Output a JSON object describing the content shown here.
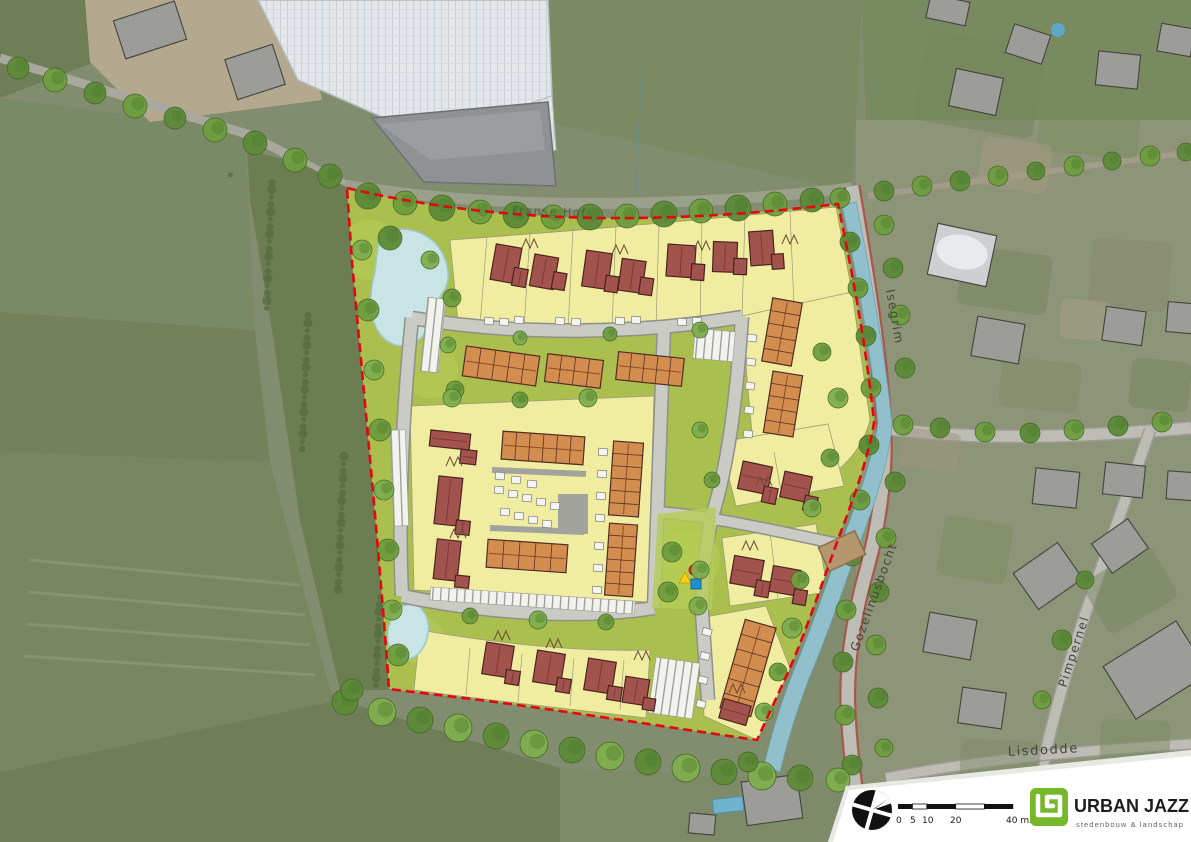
{
  "streets": {
    "franse_hof": "Franse Hof",
    "isegrim": "Isegrim",
    "gozelinusbocht": "Gozelinusbocht",
    "pimpernel": "Pimpernel",
    "lisdodde": "Lisdodde"
  },
  "legend": {
    "scale_ticks": [
      "0",
      "5",
      "10",
      "20"
    ],
    "scale_end": "40 m.",
    "logo_text": "URBAN JAZZ",
    "logo_tagline": "stedenbouw  &  landschap",
    "logo_color": "#76b82a"
  },
  "colors": {
    "boundary": "#e30613",
    "parcel_yellow": "#f1eda0",
    "public_green": "#aabf4e",
    "detached_roof": "#a3534d",
    "terraced_roof": "#d28d4f",
    "road": "#cbcbc5",
    "water": "#8fc0cc",
    "pond": "#c9e4e4",
    "bridge": "#b5976e",
    "playground_triangle": "#f7d117",
    "playground_circle": "#e63027",
    "playground_square": "#1f8fd1"
  },
  "site_plan": {
    "trees": [
      [
        368,
        196,
        13,
        1
      ],
      [
        405,
        203,
        12,
        0
      ],
      [
        442,
        208,
        13,
        1
      ],
      [
        480,
        212,
        12,
        0
      ],
      [
        516,
        215,
        13,
        1
      ],
      [
        553,
        217,
        12,
        0
      ],
      [
        590,
        217,
        13,
        1
      ],
      [
        627,
        216,
        12,
        0
      ],
      [
        664,
        214,
        13,
        1
      ],
      [
        701,
        211,
        12,
        0
      ],
      [
        738,
        208,
        13,
        1
      ],
      [
        775,
        204,
        12,
        0
      ],
      [
        812,
        200,
        12,
        1
      ],
      [
        840,
        198,
        10,
        0
      ],
      [
        18,
        68,
        11,
        1
      ],
      [
        55,
        80,
        12,
        0
      ],
      [
        95,
        93,
        11,
        1
      ],
      [
        135,
        106,
        12,
        0
      ],
      [
        175,
        118,
        11,
        1
      ],
      [
        215,
        130,
        12,
        0
      ],
      [
        255,
        143,
        12,
        1
      ],
      [
        295,
        160,
        12,
        0
      ],
      [
        330,
        176,
        12,
        1
      ],
      [
        362,
        250,
        10,
        2
      ],
      [
        368,
        310,
        11,
        0
      ],
      [
        374,
        370,
        10,
        2
      ],
      [
        380,
        430,
        11,
        0
      ],
      [
        384,
        490,
        10,
        2
      ],
      [
        388,
        550,
        11,
        0
      ],
      [
        392,
        610,
        10,
        2
      ],
      [
        398,
        655,
        11,
        0
      ],
      [
        390,
        238,
        12,
        1
      ],
      [
        430,
        260,
        9,
        2
      ],
      [
        452,
        298,
        9,
        0
      ],
      [
        448,
        345,
        8,
        2
      ],
      [
        455,
        390,
        9,
        0
      ],
      [
        452,
        398,
        9,
        2
      ],
      [
        520,
        400,
        8,
        0
      ],
      [
        588,
        398,
        9,
        2
      ],
      [
        470,
        616,
        8,
        0
      ],
      [
        538,
        620,
        9,
        2
      ],
      [
        606,
        622,
        8,
        0
      ],
      [
        520,
        338,
        7,
        2
      ],
      [
        610,
        334,
        7,
        0
      ],
      [
        700,
        330,
        8,
        2
      ],
      [
        672,
        552,
        10,
        0
      ],
      [
        700,
        570,
        9,
        2
      ],
      [
        668,
        592,
        10,
        0
      ],
      [
        698,
        606,
        9,
        2
      ],
      [
        712,
        480,
        8,
        0
      ],
      [
        700,
        430,
        8,
        2
      ],
      [
        822,
        352,
        9,
        0
      ],
      [
        838,
        398,
        10,
        2
      ],
      [
        830,
        458,
        9,
        0
      ],
      [
        812,
        508,
        9,
        2
      ],
      [
        800,
        580,
        9,
        0
      ],
      [
        792,
        628,
        10,
        2
      ],
      [
        778,
        672,
        9,
        0
      ],
      [
        764,
        712,
        9,
        2
      ],
      [
        850,
        242,
        10,
        1
      ],
      [
        858,
        288,
        10,
        0
      ],
      [
        866,
        336,
        10,
        1
      ],
      [
        871,
        388,
        10,
        0
      ],
      [
        869,
        445,
        10,
        1
      ],
      [
        860,
        500,
        10,
        0
      ],
      [
        852,
        556,
        10,
        1
      ],
      [
        846,
        610,
        10,
        0
      ],
      [
        843,
        662,
        10,
        1
      ],
      [
        845,
        715,
        10,
        0
      ],
      [
        852,
        765,
        10,
        1
      ],
      [
        884,
        225,
        10,
        0
      ],
      [
        893,
        268,
        10,
        1
      ],
      [
        900,
        315,
        10,
        0
      ],
      [
        905,
        368,
        10,
        1
      ],
      [
        903,
        425,
        10,
        0
      ],
      [
        895,
        482,
        10,
        1
      ],
      [
        886,
        538,
        10,
        0
      ],
      [
        879,
        592,
        10,
        1
      ],
      [
        876,
        645,
        10,
        0
      ],
      [
        878,
        698,
        10,
        1
      ],
      [
        884,
        748,
        9,
        0
      ],
      [
        940,
        428,
        10,
        1
      ],
      [
        985,
        432,
        10,
        0
      ],
      [
        1030,
        433,
        10,
        1
      ],
      [
        1074,
        430,
        10,
        0
      ],
      [
        1118,
        426,
        10,
        1
      ],
      [
        1162,
        422,
        10,
        0
      ],
      [
        884,
        191,
        10,
        1
      ],
      [
        922,
        186,
        10,
        0
      ],
      [
        960,
        181,
        10,
        1
      ],
      [
        998,
        176,
        10,
        0
      ],
      [
        1036,
        171,
        9,
        1
      ],
      [
        1074,
        166,
        10,
        0
      ],
      [
        1112,
        161,
        9,
        1
      ],
      [
        1150,
        156,
        10,
        0
      ],
      [
        1186,
        152,
        9,
        1
      ],
      [
        1062,
        640,
        10,
        1
      ],
      [
        1042,
        700,
        9,
        0
      ],
      [
        1085,
        580,
        9,
        1
      ],
      [
        345,
        702,
        13,
        1
      ],
      [
        382,
        712,
        14,
        2
      ],
      [
        420,
        720,
        13,
        1
      ],
      [
        458,
        728,
        14,
        2
      ],
      [
        496,
        736,
        13,
        1
      ],
      [
        534,
        744,
        14,
        2
      ],
      [
        572,
        750,
        13,
        1
      ],
      [
        610,
        756,
        14,
        2
      ],
      [
        648,
        762,
        13,
        1
      ],
      [
        686,
        768,
        14,
        2
      ],
      [
        724,
        772,
        13,
        1
      ],
      [
        762,
        776,
        14,
        2
      ],
      [
        800,
        778,
        13,
        1
      ],
      [
        838,
        780,
        12,
        2
      ],
      [
        352,
        690,
        11,
        1
      ],
      [
        748,
        762,
        10,
        1
      ]
    ],
    "detached_houses": [
      {
        "x": 507,
        "y": 264,
        "r": 10,
        "parts": [
          [
            -14,
            -18,
            26,
            36
          ],
          [
            8,
            2,
            14,
            18
          ]
        ]
      },
      {
        "x": 545,
        "y": 272,
        "r": 10,
        "parts": [
          [
            -13,
            -16,
            24,
            32
          ],
          [
            9,
            -2,
            13,
            17
          ]
        ]
      },
      {
        "x": 598,
        "y": 270,
        "r": 8,
        "parts": [
          [
            -14,
            -18,
            26,
            36
          ],
          [
            9,
            4,
            13,
            16
          ]
        ]
      },
      {
        "x": 633,
        "y": 276,
        "r": 8,
        "parts": [
          [
            -13,
            -16,
            24,
            32
          ],
          [
            8,
            0,
            13,
            17
          ]
        ]
      },
      {
        "x": 682,
        "y": 261,
        "r": 4,
        "parts": [
          [
            -15,
            -16,
            28,
            32
          ],
          [
            10,
            2,
            13,
            16
          ]
        ]
      },
      {
        "x": 726,
        "y": 257,
        "r": 2,
        "parts": [
          [
            -13,
            -15,
            24,
            30
          ],
          [
            8,
            1,
            13,
            16
          ]
        ]
      },
      {
        "x": 763,
        "y": 251,
        "r": -4,
        "parts": [
          [
            -13,
            -20,
            24,
            34
          ],
          [
            8,
            4,
            12,
            15
          ]
        ]
      },
      {
        "x": 450,
        "y": 440,
        "r": 6,
        "parts": [
          [
            -20,
            -8,
            40,
            16
          ],
          [
            12,
            8,
            16,
            14
          ]
        ]
      },
      {
        "x": 448,
        "y": 505,
        "r": 6,
        "parts": [
          [
            -12,
            -28,
            24,
            48
          ],
          [
            10,
            14,
            14,
            14
          ]
        ]
      },
      {
        "x": 447,
        "y": 562,
        "r": 6,
        "parts": [
          [
            -12,
            -22,
            24,
            40
          ],
          [
            10,
            12,
            14,
            12
          ]
        ]
      },
      {
        "x": 498,
        "y": 660,
        "r": 9,
        "parts": [
          [
            -14,
            -16,
            28,
            32
          ],
          [
            10,
            8,
            14,
            14
          ]
        ]
      },
      {
        "x": 549,
        "y": 668,
        "r": 9,
        "parts": [
          [
            -14,
            -16,
            28,
            32
          ],
          [
            10,
            8,
            14,
            14
          ]
        ]
      },
      {
        "x": 600,
        "y": 676,
        "r": 9,
        "parts": [
          [
            -14,
            -16,
            28,
            32
          ],
          [
            10,
            8,
            14,
            14
          ]
        ]
      },
      {
        "x": 636,
        "y": 690,
        "r": 9,
        "parts": [
          [
            -12,
            -12,
            24,
            26
          ],
          [
            9,
            6,
            12,
            12
          ]
        ]
      },
      {
        "x": 756,
        "y": 478,
        "r": 12,
        "parts": [
          [
            -16,
            -14,
            30,
            28
          ],
          [
            10,
            6,
            14,
            16
          ]
        ]
      },
      {
        "x": 797,
        "y": 487,
        "r": 12,
        "parts": [
          [
            -15,
            -13,
            28,
            26
          ],
          [
            10,
            6,
            13,
            15
          ]
        ]
      },
      {
        "x": 748,
        "y": 572,
        "r": 10,
        "parts": [
          [
            -16,
            -14,
            30,
            28
          ],
          [
            10,
            6,
            14,
            16
          ]
        ]
      },
      {
        "x": 786,
        "y": 581,
        "r": 10,
        "parts": [
          [
            -15,
            -13,
            28,
            26
          ],
          [
            10,
            6,
            13,
            15
          ]
        ]
      },
      {
        "x": 735,
        "y": 712,
        "r": 16,
        "parts": [
          [
            -14,
            -10,
            28,
            20
          ]
        ]
      }
    ],
    "terraced_blocks": [
      [
        501,
        366,
        74,
        30,
        8,
        5
      ],
      [
        574,
        371,
        56,
        28,
        7,
        4
      ],
      [
        650,
        369,
        66,
        28,
        6,
        5
      ],
      [
        782,
        332,
        30,
        64,
        10,
        5
      ],
      [
        783,
        404,
        30,
        62,
        9,
        5
      ],
      [
        543,
        448,
        82,
        28,
        4,
        6
      ],
      [
        527,
        556,
        80,
        28,
        4,
        5
      ],
      [
        626,
        479,
        30,
        74,
        4,
        6
      ],
      [
        621,
        560,
        28,
        72,
        4,
        6
      ],
      [
        748,
        668,
        32,
        92,
        16,
        6
      ]
    ],
    "sheds": [
      [
        489,
        321,
        6
      ],
      [
        504,
        322,
        6
      ],
      [
        519,
        320,
        6
      ],
      [
        560,
        321,
        5
      ],
      [
        576,
        322,
        5
      ],
      [
        620,
        321,
        4
      ],
      [
        636,
        320,
        4
      ],
      [
        682,
        322,
        3
      ],
      [
        697,
        321,
        3
      ],
      [
        499,
        490,
        5
      ],
      [
        513,
        494,
        5
      ],
      [
        527,
        498,
        5
      ],
      [
        541,
        502,
        5
      ],
      [
        555,
        506,
        5
      ],
      [
        505,
        512,
        5
      ],
      [
        519,
        516,
        5
      ],
      [
        533,
        520,
        5
      ],
      [
        547,
        524,
        5
      ],
      [
        500,
        476,
        5
      ],
      [
        516,
        480,
        5
      ],
      [
        532,
        484,
        5
      ],
      [
        752,
        338,
        8
      ],
      [
        751,
        362,
        8
      ],
      [
        750,
        386,
        8
      ],
      [
        749,
        410,
        8
      ],
      [
        748,
        434,
        8
      ],
      [
        603,
        452,
        4
      ],
      [
        602,
        474,
        4
      ],
      [
        601,
        496,
        4
      ],
      [
        600,
        518,
        4
      ],
      [
        599,
        546,
        4
      ],
      [
        598,
        568,
        4
      ],
      [
        597,
        590,
        4
      ],
      [
        707,
        632,
        14
      ],
      [
        705,
        656,
        14
      ],
      [
        703,
        680,
        14
      ],
      [
        701,
        704,
        14
      ]
    ]
  },
  "surroundings": {
    "buildings": [
      [
        976,
        92,
        48,
        38,
        12,
        0
      ],
      [
        1028,
        44,
        38,
        30,
        18,
        0
      ],
      [
        1118,
        70,
        42,
        34,
        6,
        0
      ],
      [
        1176,
        40,
        34,
        28,
        10,
        0
      ],
      [
        948,
        10,
        40,
        24,
        12,
        0
      ],
      [
        962,
        255,
        60,
        52,
        12,
        1
      ],
      [
        998,
        340,
        48,
        40,
        10,
        0
      ],
      [
        1124,
        326,
        40,
        34,
        8,
        0
      ],
      [
        1184,
        318,
        34,
        30,
        5,
        0
      ],
      [
        1056,
        488,
        44,
        36,
        6,
        0
      ],
      [
        1124,
        480,
        40,
        32,
        6,
        0
      ],
      [
        1184,
        486,
        34,
        28,
        4,
        0
      ],
      [
        1048,
        576,
        54,
        44,
        -35,
        0
      ],
      [
        1120,
        546,
        44,
        36,
        -35,
        0
      ],
      [
        950,
        636,
        48,
        40,
        10,
        0
      ],
      [
        982,
        708,
        44,
        36,
        8,
        0
      ],
      [
        1156,
        670,
        86,
        62,
        -32,
        0
      ],
      [
        1036,
        824,
        48,
        36,
        2,
        0
      ],
      [
        1152,
        818,
        56,
        44,
        2,
        0
      ],
      [
        930,
        804,
        40,
        32,
        8,
        0
      ],
      [
        772,
        800,
        56,
        44,
        -8,
        0
      ],
      [
        702,
        824,
        26,
        20,
        5,
        0
      ],
      [
        150,
        30,
        64,
        40,
        -18,
        0
      ],
      [
        255,
        72,
        50,
        42,
        -18,
        0
      ]
    ],
    "gardens": [
      [
        980,
        85,
        120,
        90,
        10,
        "#76855c",
        0.55
      ],
      [
        1090,
        120,
        100,
        70,
        5,
        "#7c8a60",
        0.5
      ],
      [
        1005,
        280,
        90,
        60,
        8,
        "#79875e",
        0.55
      ],
      [
        1130,
        275,
        80,
        70,
        4,
        "#888a70",
        0.5
      ],
      [
        1040,
        385,
        80,
        50,
        6,
        "#7f8c64",
        0.5
      ],
      [
        1160,
        385,
        60,
        50,
        6,
        "#75845c",
        0.5
      ],
      [
        975,
        550,
        70,
        60,
        10,
        "#7d8b62",
        0.55
      ],
      [
        1130,
        590,
        80,
        60,
        -30,
        "#778660",
        0.5
      ],
      [
        1000,
        765,
        80,
        50,
        3,
        "#80896a",
        0.5
      ],
      [
        1135,
        745,
        70,
        50,
        2,
        "#7b8a62",
        0.5
      ],
      [
        1015,
        165,
        70,
        50,
        8,
        "#a49a82",
        0.55
      ],
      [
        1085,
        320,
        50,
        40,
        5,
        "#a89f88",
        0.5
      ],
      [
        930,
        450,
        60,
        40,
        8,
        "#9e9680",
        0.5
      ]
    ]
  }
}
